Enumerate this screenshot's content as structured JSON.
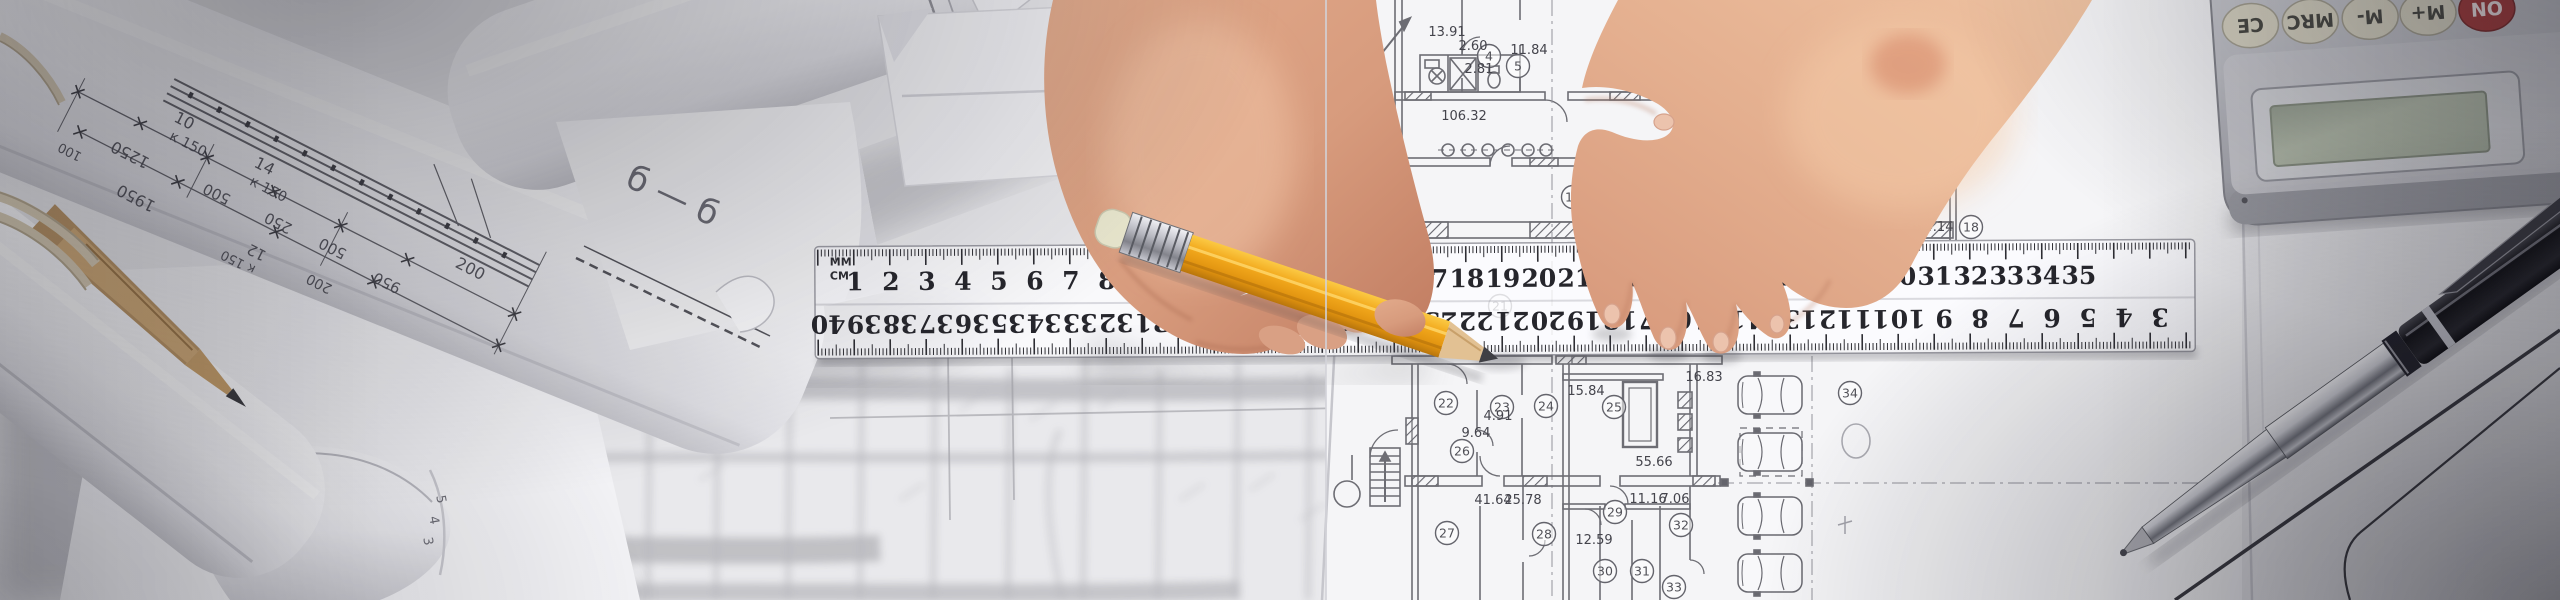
{
  "colors": {
    "paper": "#e9e9ec",
    "plan_sheet": "#f5f5f7",
    "blueprint_line": "#5f5f66",
    "pencil_yellow": "#f0a61c",
    "pencil_eraser": "#e8e6cd",
    "pencil_wood": "#e2c193",
    "skin_light": "#eab795",
    "skin_dark": "#c8846a",
    "calculator_body": "#c6c7cc",
    "calculator_on_red": "#a83e3e",
    "calculator_lcd": "#b2baa9",
    "pen_black": "#1b1b1f",
    "twine": "#d8ccb4"
  },
  "ruler": {
    "unit_top": "MM",
    "unit_bottom": "CM",
    "top_numbers": [
      1,
      2,
      3,
      4,
      5,
      6,
      7,
      8,
      9,
      10,
      11,
      12,
      13,
      14,
      15,
      16,
      17,
      18,
      19,
      20,
      21,
      22,
      23,
      24,
      25,
      26,
      27,
      28,
      29,
      30,
      31,
      32,
      33,
      34,
      35
    ],
    "bottom_numbers": [
      40,
      39,
      38,
      37,
      36,
      35,
      34,
      33,
      32,
      31,
      30,
      29,
      28,
      27,
      26,
      25,
      24,
      23,
      22,
      21,
      20,
      19,
      18,
      17,
      16,
      15,
      14,
      13,
      12,
      11,
      10,
      9,
      8,
      7,
      6,
      5,
      4,
      3,
      2,
      1
    ]
  },
  "floor_plan": {
    "rooms": [
      {
        "n": "4",
        "x": 1489,
        "y": 56
      },
      {
        "n": "5",
        "x": 1518,
        "y": 66
      },
      {
        "n": "11",
        "x": 1573,
        "y": 197
      },
      {
        "n": "18",
        "x": 1971,
        "y": 227
      },
      {
        "n": "21",
        "x": 1500,
        "y": 306
      },
      {
        "n": "20",
        "x": 1660,
        "y": 307
      },
      {
        "n": "22",
        "x": 1446,
        "y": 403
      },
      {
        "n": "23",
        "x": 1502,
        "y": 407
      },
      {
        "n": "24",
        "x": 1546,
        "y": 406
      },
      {
        "n": "25",
        "x": 1614,
        "y": 407
      },
      {
        "n": "26",
        "x": 1462,
        "y": 451
      },
      {
        "n": "27",
        "x": 1447,
        "y": 533
      },
      {
        "n": "28",
        "x": 1544,
        "y": 534
      },
      {
        "n": "29",
        "x": 1615,
        "y": 512
      },
      {
        "n": "30",
        "x": 1605,
        "y": 571
      },
      {
        "n": "31",
        "x": 1642,
        "y": 571
      },
      {
        "n": "32",
        "x": 1681,
        "y": 525
      },
      {
        "n": "33",
        "x": 1674,
        "y": 587
      },
      {
        "n": "34",
        "x": 1850,
        "y": 393
      }
    ],
    "dimensions": [
      {
        "t": "13.91",
        "x": 1447,
        "y": 36
      },
      {
        "t": "2.60",
        "x": 1473,
        "y": 50
      },
      {
        "t": "11.84",
        "x": 1529,
        "y": 54
      },
      {
        "t": "2.81",
        "x": 1479,
        "y": 73
      },
      {
        "t": "17.80",
        "x": 1627,
        "y": 68
      },
      {
        "t": "106.32",
        "x": 1464,
        "y": 120
      },
      {
        "t": "4.14",
        "x": 1939,
        "y": 231
      },
      {
        "t": "15.84",
        "x": 1586,
        "y": 395
      },
      {
        "t": "4.91",
        "x": 1498,
        "y": 420
      },
      {
        "t": "9.64",
        "x": 1476,
        "y": 437
      },
      {
        "t": "16.83",
        "x": 1704,
        "y": 381
      },
      {
        "t": "55.66",
        "x": 1654,
        "y": 466
      },
      {
        "t": "41.64",
        "x": 1493,
        "y": 504
      },
      {
        "t": "25.78",
        "x": 1523,
        "y": 504
      },
      {
        "t": "11.16",
        "x": 1648,
        "y": 503
      },
      {
        "t": "7.06",
        "x": 1675,
        "y": 503
      },
      {
        "t": "12.59",
        "x": 1594,
        "y": 544
      }
    ],
    "cars": [
      {
        "x": 1770,
        "y": 395
      },
      {
        "x": 1770,
        "y": 452
      },
      {
        "x": 1770,
        "y": 516
      },
      {
        "x": 1770,
        "y": 573
      }
    ]
  },
  "roll_drawing": {
    "labels": [
      {
        "t": "10",
        "x": 238,
        "y": 188,
        "r": 0,
        "s": 16
      },
      {
        "t": "к 150",
        "x": 252,
        "y": 206,
        "r": 0,
        "s": 14
      },
      {
        "t": "14",
        "x": 330,
        "y": 192,
        "r": 0,
        "s": 16
      },
      {
        "t": "к 150",
        "x": 344,
        "y": 210,
        "r": 0,
        "s": 14
      },
      {
        "t": "200",
        "x": 560,
        "y": 190,
        "r": 0,
        "s": 16
      },
      {
        "t": "1250",
        "x": 205,
        "y": 232,
        "r": 180,
        "s": 16
      },
      {
        "t": "500",
        "x": 300,
        "y": 228,
        "r": 180,
        "s": 15
      },
      {
        "t": "250",
        "x": 368,
        "y": 226,
        "r": 180,
        "s": 15
      },
      {
        "t": "500",
        "x": 428,
        "y": 224,
        "r": 180,
        "s": 15
      },
      {
        "t": "950",
        "x": 492,
        "y": 230,
        "r": 180,
        "s": 15
      },
      {
        "t": "1950",
        "x": 230,
        "y": 268,
        "r": 180,
        "s": 16
      },
      {
        "t": "12",
        "x": 362,
        "y": 262,
        "r": 180,
        "s": 15
      },
      {
        "t": "к 150",
        "x": 350,
        "y": 280,
        "r": 180,
        "s": 13
      },
      {
        "t": "200",
        "x": 432,
        "y": 262,
        "r": 180,
        "s": 14
      },
      {
        "t": "100",
        "x": 150,
        "y": 258,
        "r": 180,
        "s": 13
      }
    ],
    "section_label": "б — б"
  },
  "curl_digits": [
    {
      "t": "5",
      "x": 437,
      "y": 500
    },
    {
      "t": "4",
      "x": 430,
      "y": 521
    },
    {
      "t": "3",
      "x": 424,
      "y": 542
    }
  ],
  "calculator": {
    "buttons": [
      {
        "label": "CE",
        "x": 2256,
        "style": "cream"
      },
      {
        "label": "MRC",
        "x": 2316,
        "style": "cream"
      },
      {
        "label": "M-",
        "x": 2376,
        "style": "cream"
      },
      {
        "label": "M+",
        "x": 2434,
        "style": "cream"
      },
      {
        "label": "ON",
        "x": 2493,
        "style": "red"
      }
    ]
  }
}
